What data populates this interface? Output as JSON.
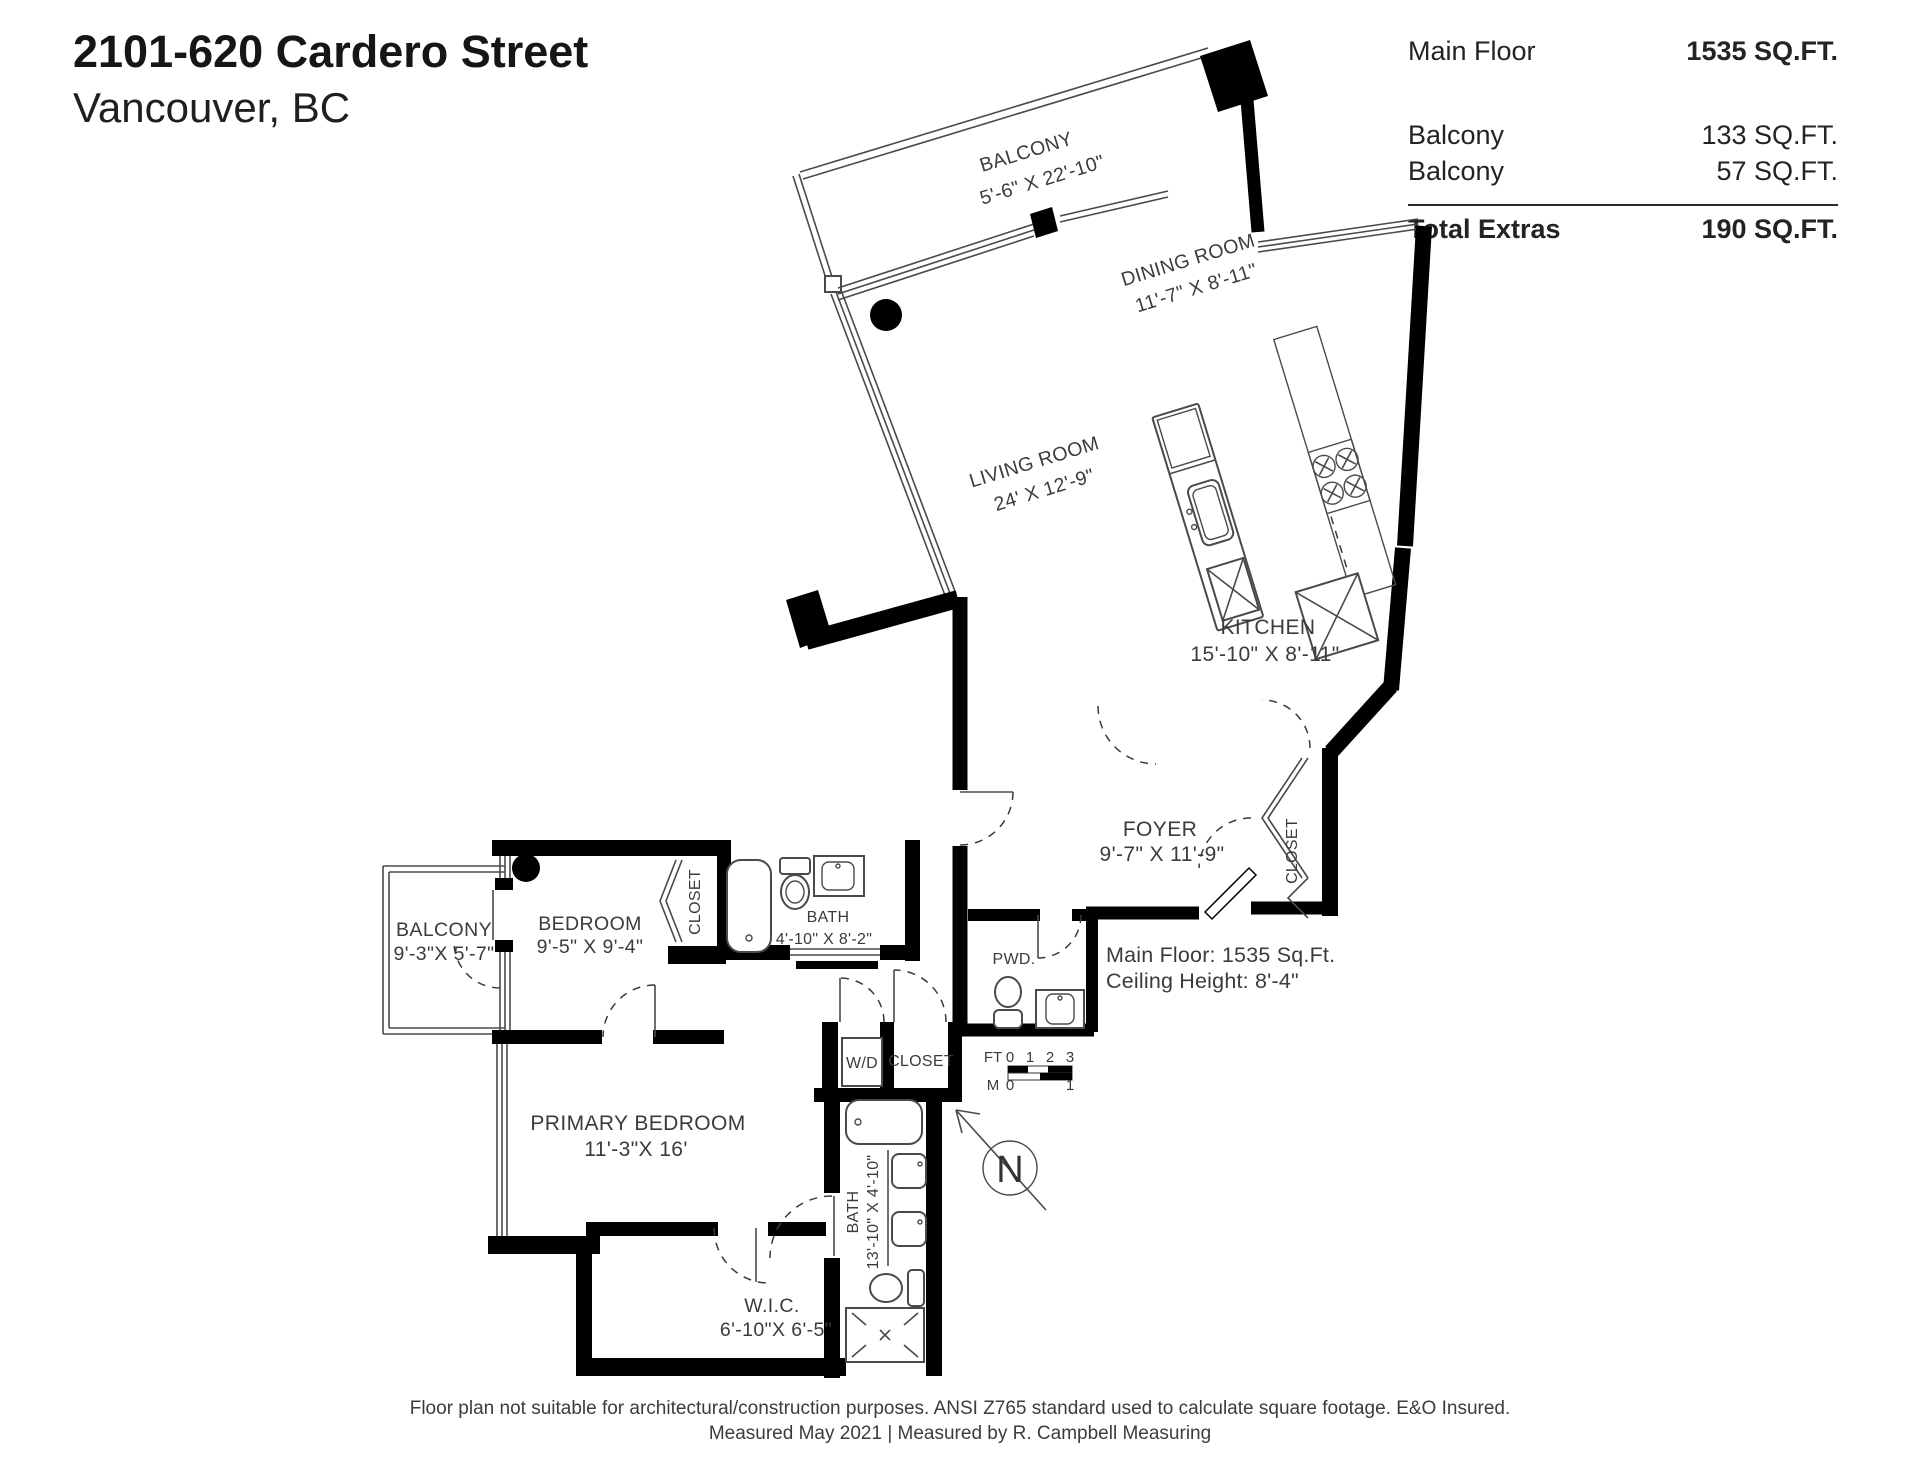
{
  "header": {
    "title": "2101-620 Cardero Street",
    "subtitle": "Vancouver, BC"
  },
  "area_table": {
    "rows": [
      {
        "label": "Main Floor",
        "value": "1535 SQ.FT."
      },
      {
        "label": "Balcony",
        "value": "133 SQ.FT."
      },
      {
        "label": "Balcony",
        "value": "57 SQ.FT."
      }
    ],
    "total_label": "Total Extras",
    "total_value": "190 SQ.FT."
  },
  "rooms": {
    "balcony_top": {
      "name": "BALCONY",
      "dims": "5'-6\" X 22'-10\""
    },
    "dining": {
      "name": "DINING ROOM",
      "dims": "11'-7\" X  8'-11\""
    },
    "living": {
      "name": "LIVING ROOM",
      "dims": "24' X 12'-9\""
    },
    "kitchen": {
      "name": "KITCHEN",
      "dims": "15'-10\" X 8'-11\""
    },
    "foyer": {
      "name": "FOYER",
      "dims": "9'-7\"  X 11'-9\""
    },
    "closet_foyer": {
      "name": "CLOSET"
    },
    "pwd": {
      "name": "PWD."
    },
    "bedroom": {
      "name": "BEDROOM",
      "dims": "9'-5\" X 9'-4\""
    },
    "closet_bedroom": {
      "name": "CLOSET"
    },
    "bath_upper": {
      "name": "BATH",
      "dims": "4'-10\" X 8'-2\""
    },
    "balcony_left": {
      "name": "BALCONY",
      "dims": "9'-3\"X 5'-7\""
    },
    "wd": {
      "name": "W/D"
    },
    "closet_hall": {
      "name": "CLOSET"
    },
    "primary": {
      "name": "PRIMARY BEDROOM",
      "dims": "11'-3\"X 16'"
    },
    "bath_lower": {
      "name": "BATH",
      "dims": "13'-10\" X 4'-10\""
    },
    "wic": {
      "name": "W.I.C.",
      "dims": "6'-10\"X 6'-5\""
    }
  },
  "notes": {
    "main_floor": "Main Floor: 1535 Sq.Ft.",
    "ceiling": "Ceiling Height: 8'-4\""
  },
  "scale_bar": {
    "ft_label": "FT",
    "ft_ticks": [
      "0",
      "1",
      "2",
      "3"
    ],
    "m_label": "M",
    "m_ticks": [
      "0",
      "1"
    ]
  },
  "compass": {
    "label": "N"
  },
  "footer": {
    "line1": "Floor plan not suitable for architectural/construction purposes. ANSI Z765 standard used to calculate square footage. E&O Insured.",
    "line2": "Measured May 2021 | Measured by R. Campbell Measuring"
  }
}
